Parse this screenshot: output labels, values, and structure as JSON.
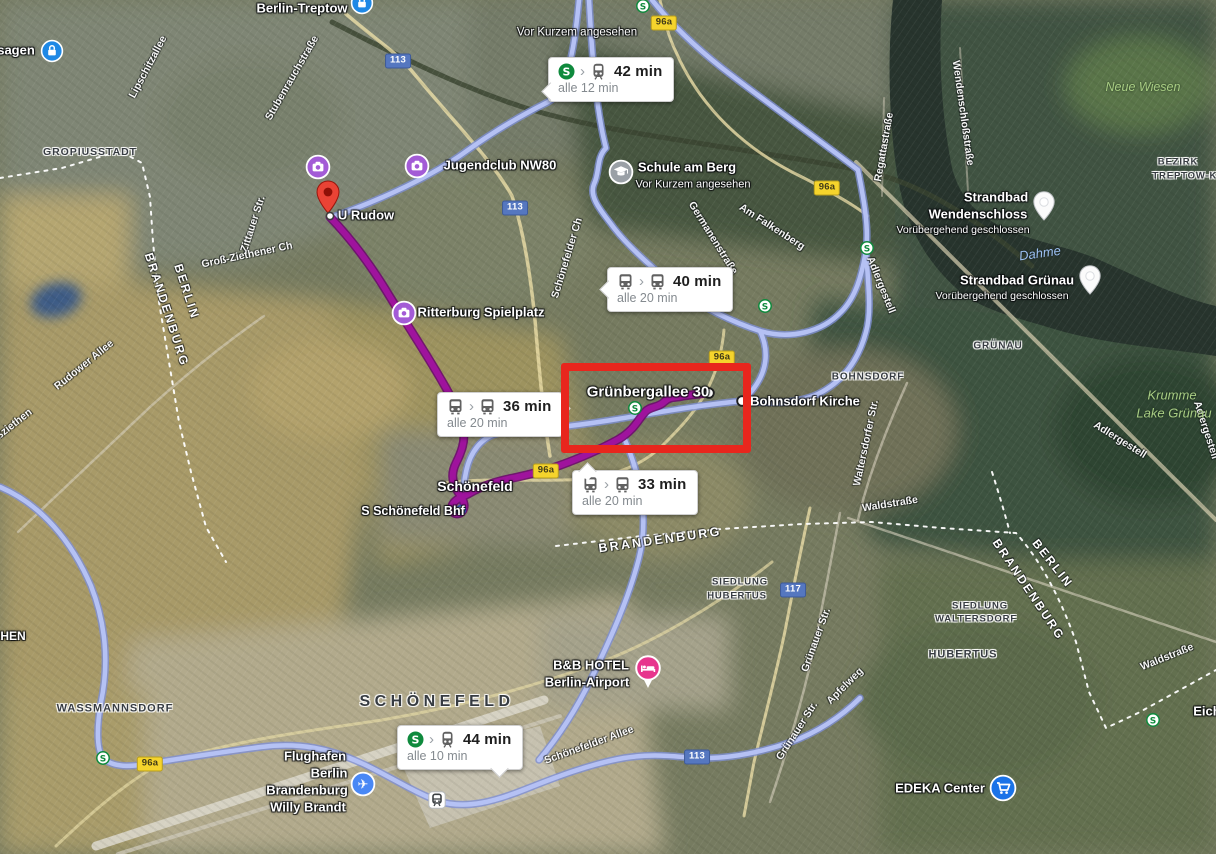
{
  "colors": {
    "route_blue": "#b7c3f6",
    "route_blue_edge": "#7e8fd4",
    "route_purple": "#a0139e",
    "route_purple_edge": "#6d0a6e",
    "highlight_red": "#e8261d",
    "shield_yellow_bg": "#f5d42c",
    "shield_yellow_text": "#403a18",
    "shield_yellow_border": "#b89e1d",
    "shield_blue_bg": "#5577c0",
    "shield_blue_text": "#ffffff",
    "sbahn_green": "#0f8a3d",
    "bubble_bg": "#ffffff"
  },
  "highlight_box": {
    "x": 561,
    "y": 363,
    "width": 174,
    "height": 74,
    "label": "Grünbergallee 30"
  },
  "transit_bubbles": [
    {
      "time": "42 min",
      "frequency": "alle 12 min",
      "mode_icons": [
        "sbahn-logo",
        "train"
      ],
      "x": 548,
      "y": 57,
      "tail": "bottom-left"
    },
    {
      "time": "40 min",
      "frequency": "alle 20 min",
      "mode_icons": [
        "bus",
        "bus"
      ],
      "x": 607,
      "y": 267,
      "tail": "left"
    },
    {
      "time": "36 min",
      "frequency": "alle 20 min",
      "mode_icons": [
        "bus",
        "bus"
      ],
      "x": 437,
      "y": 392,
      "tail": "right-top"
    },
    {
      "time": "33 min",
      "frequency": "alle 20 min",
      "mode_icons": [
        "bus",
        "bus"
      ],
      "x": 572,
      "y": 470,
      "tail": "left-top"
    },
    {
      "time": "44 min",
      "frequency": "alle 10 min",
      "mode_icons": [
        "sbahn-logo",
        "train"
      ],
      "x": 397,
      "y": 725,
      "tail": "bottom-right"
    }
  ],
  "route_shields": [
    {
      "label": "96a",
      "style": "yellow",
      "x": 664,
      "y": 23
    },
    {
      "label": "96a",
      "style": "yellow",
      "x": 827,
      "y": 188
    },
    {
      "label": "96a",
      "style": "yellow",
      "x": 722,
      "y": 358
    },
    {
      "label": "96a",
      "style": "yellow",
      "x": 546,
      "y": 471
    },
    {
      "label": "96a",
      "style": "yellow",
      "x": 150,
      "y": 764
    },
    {
      "label": "113",
      "style": "blue",
      "x": 398,
      "y": 61
    },
    {
      "label": "113",
      "style": "blue",
      "x": 515,
      "y": 208
    },
    {
      "label": "113",
      "style": "blue",
      "x": 697,
      "y": 757
    },
    {
      "label": "117",
      "style": "blue",
      "x": 793,
      "y": 590
    }
  ],
  "markers": [
    {
      "type": "lock",
      "x": 52,
      "y": 51
    },
    {
      "type": "lock",
      "x": 362,
      "y": 3
    },
    {
      "type": "sbahn",
      "x": 643,
      "y": 6
    },
    {
      "type": "camera",
      "x": 318,
      "y": 167
    },
    {
      "type": "camera",
      "x": 417,
      "y": 166
    },
    {
      "type": "pin-red",
      "x": 328,
      "y": 214,
      "anchor": "bottom"
    },
    {
      "type": "stop",
      "x": 330,
      "y": 216
    },
    {
      "type": "camera",
      "x": 404,
      "y": 313
    },
    {
      "type": "school",
      "x": 621,
      "y": 172
    },
    {
      "type": "pin-white",
      "x": 1044,
      "y": 221,
      "anchor": "bottom"
    },
    {
      "type": "pin-white",
      "x": 1090,
      "y": 295,
      "anchor": "bottom"
    },
    {
      "type": "sbahn",
      "x": 867,
      "y": 248
    },
    {
      "type": "stop-lg",
      "x": 742,
      "y": 401
    },
    {
      "type": "stop-lg",
      "x": 709,
      "y": 393
    },
    {
      "type": "sbahn",
      "x": 635,
      "y": 408
    },
    {
      "type": "stop-blue",
      "x": 461,
      "y": 510
    },
    {
      "type": "pin-hotel",
      "x": 648,
      "y": 690,
      "anchor": "bottom"
    },
    {
      "type": "airplane",
      "x": 363,
      "y": 784
    },
    {
      "type": "station",
      "x": 437,
      "y": 800
    },
    {
      "type": "sbahn",
      "x": 103,
      "y": 758
    },
    {
      "type": "sbahn",
      "x": 765,
      "y": 306
    },
    {
      "type": "sbahn",
      "x": 1153,
      "y": 720
    },
    {
      "type": "cart",
      "x": 1003,
      "y": 788
    }
  ],
  "labels": [
    {
      "text": "Berlin-Treptow",
      "x": 302,
      "y": 9,
      "cls": "poi",
      "size": 13
    },
    {
      "text": "sagen",
      "x": 16,
      "y": 51,
      "cls": "poi",
      "size": 13
    },
    {
      "text": "Vor Kurzem angesehen",
      "x": 577,
      "y": 33,
      "cls": "poi-sub",
      "size": 11.5
    },
    {
      "text": "Jugendclub NW80",
      "x": 500,
      "y": 166,
      "cls": "poi",
      "size": 13
    },
    {
      "text": "U Rudow",
      "x": 366,
      "y": 216,
      "cls": "poi",
      "size": 13
    },
    {
      "text": "Ritterburg Spielplatz",
      "x": 481,
      "y": 313,
      "cls": "poi",
      "size": 13
    },
    {
      "text": "Schule am Berg",
      "x": 687,
      "y": 168,
      "cls": "poi",
      "size": 13
    },
    {
      "text": "Vor Kurzem angesehen",
      "x": 693,
      "y": 185,
      "cls": "poi-sub",
      "size": 11
    },
    {
      "text": "Strandbad",
      "x": 996,
      "y": 198,
      "cls": "poi",
      "size": 13
    },
    {
      "text": "Wendenschloss",
      "x": 978,
      "y": 215,
      "cls": "poi",
      "size": 13
    },
    {
      "text": "Vorübergehend geschlossen",
      "x": 963,
      "y": 230,
      "cls": "poi-sub",
      "size": 10.5
    },
    {
      "text": "Strandbad Grünau",
      "x": 1017,
      "y": 281,
      "cls": "poi",
      "size": 13
    },
    {
      "text": "Vorübergehend geschlossen",
      "x": 1002,
      "y": 296,
      "cls": "poi-sub",
      "size": 10.5
    },
    {
      "text": "Bohnsdorf Kirche",
      "x": 805,
      "y": 402,
      "cls": "poi",
      "size": 13
    },
    {
      "text": "Grünbergallee 30",
      "x": 648,
      "y": 392,
      "cls": "dest",
      "size": 15
    },
    {
      "text": "Schönefeld",
      "x": 475,
      "y": 486,
      "cls": "poi",
      "size": 14
    },
    {
      "text": "S Schönefeld Bhf",
      "x": 413,
      "y": 511,
      "cls": "poi",
      "size": 12.5
    },
    {
      "text": "B&B HOTEL",
      "x": 591,
      "y": 666,
      "cls": "poi",
      "size": 13
    },
    {
      "text": "Berlin-Airport",
      "x": 587,
      "y": 683,
      "cls": "poi",
      "size": 13
    },
    {
      "text": "Flughafen",
      "x": 315,
      "y": 757,
      "cls": "poi",
      "size": 13
    },
    {
      "text": "Berlin",
      "x": 329,
      "y": 774,
      "cls": "poi",
      "size": 13
    },
    {
      "text": "Brandenburg",
      "x": 307,
      "y": 791,
      "cls": "poi",
      "size": 13
    },
    {
      "text": "Willy Brandt",
      "x": 308,
      "y": 808,
      "cls": "poi",
      "size": 13
    },
    {
      "text": "EDEKA Center",
      "x": 940,
      "y": 789,
      "cls": "poi",
      "size": 13
    },
    {
      "text": "Eichw",
      "x": 1212,
      "y": 712,
      "cls": "poi",
      "size": 13
    },
    {
      "text": "HEN",
      "x": 13,
      "y": 637,
      "cls": "poi",
      "size": 12
    },
    {
      "text": "GROPIUSSTADT",
      "x": 90,
      "y": 152,
      "cls": "district",
      "size": 10.5
    },
    {
      "text": "WASSMANNSDORF",
      "x": 115,
      "y": 709,
      "cls": "district",
      "size": 11
    },
    {
      "text": "SCHÖNEFELD",
      "x": 437,
      "y": 702,
      "cls": "district-big",
      "size": 16
    },
    {
      "text": "BOHNSDORF",
      "x": 868,
      "y": 377,
      "cls": "district",
      "size": 10
    },
    {
      "text": "GRÜNAU",
      "x": 998,
      "y": 346,
      "cls": "district",
      "size": 10
    },
    {
      "text": "SIEDLUNG",
      "x": 740,
      "y": 583,
      "cls": "district",
      "size": 9.5
    },
    {
      "text": "HUBERTUS",
      "x": 737,
      "y": 597,
      "cls": "district",
      "size": 9.5
    },
    {
      "text": "SIEDLUNG",
      "x": 980,
      "y": 607,
      "cls": "district",
      "size": 9.5
    },
    {
      "text": "WALTERSDORF",
      "x": 976,
      "y": 620,
      "cls": "district",
      "size": 9.5
    },
    {
      "text": "HUBERTUS",
      "x": 963,
      "y": 655,
      "cls": "district",
      "size": 11
    },
    {
      "text": "BEZIRK",
      "x": 1178,
      "y": 163,
      "cls": "district",
      "size": 9.5
    },
    {
      "text": "TREPTOW-KÖPEN",
      "x": 1200,
      "y": 177,
      "cls": "district",
      "size": 9.5
    },
    {
      "text": "BERLIN",
      "x": 186,
      "y": 292,
      "cls": "state",
      "size": 12,
      "rot": 72
    },
    {
      "text": "BRANDENBURG",
      "x": 166,
      "y": 310,
      "cls": "state",
      "size": 12,
      "rot": 72
    },
    {
      "text": "BRANDENBURG",
      "x": 660,
      "y": 540,
      "cls": "state",
      "size": 12.5,
      "rot": -8
    },
    {
      "text": "BERLIN",
      "x": 1052,
      "y": 564,
      "cls": "state",
      "size": 12,
      "rot": 52
    },
    {
      "text": "BRANDENBURG",
      "x": 1028,
      "y": 590,
      "cls": "state",
      "size": 12,
      "rot": 56
    },
    {
      "text": "Lipschitzallee",
      "x": 148,
      "y": 67,
      "cls": "street",
      "size": 10.5,
      "rot": -62
    },
    {
      "text": "Stubenrauchstraße",
      "x": 292,
      "y": 78,
      "cls": "street",
      "size": 10.5,
      "rot": -60
    },
    {
      "text": "Zittauer Str.",
      "x": 253,
      "y": 224,
      "cls": "street",
      "size": 10.5,
      "rot": -72
    },
    {
      "text": "Groß-Ziethener Ch",
      "x": 247,
      "y": 255,
      "cls": "street",
      "size": 10.5,
      "rot": -12
    },
    {
      "text": "Schönefelder Ch",
      "x": 567,
      "y": 258,
      "cls": "street",
      "size": 10.5,
      "rot": -73
    },
    {
      "text": "Germanenstraße",
      "x": 713,
      "y": 238,
      "cls": "street",
      "size": 10.5,
      "rot": 58
    },
    {
      "text": "Am Falkenberg",
      "x": 772,
      "y": 227,
      "cls": "street",
      "size": 10.5,
      "rot": 33
    },
    {
      "text": "Regattastraße",
      "x": 884,
      "y": 147,
      "cls": "street",
      "size": 10.5,
      "rot": -80
    },
    {
      "text": "Wendenschloßstraße",
      "x": 963,
      "y": 113,
      "cls": "street",
      "size": 10.5,
      "rot": 82
    },
    {
      "text": "Adlergestell",
      "x": 881,
      "y": 285,
      "cls": "street",
      "size": 10.5,
      "rot": 68
    },
    {
      "text": "Adlergestell",
      "x": 1120,
      "y": 440,
      "cls": "street",
      "size": 10.5,
      "rot": 32
    },
    {
      "text": "Adlergestell",
      "x": 1206,
      "y": 430,
      "cls": "street",
      "size": 10.5,
      "rot": 72
    },
    {
      "text": "Waltersdorfer Str.",
      "x": 866,
      "y": 443,
      "cls": "street",
      "size": 10.5,
      "rot": -78
    },
    {
      "text": "Waldstraße",
      "x": 890,
      "y": 504,
      "cls": "street",
      "size": 10.5,
      "rot": -9
    },
    {
      "text": "Waldstraße",
      "x": 1167,
      "y": 657,
      "cls": "street",
      "size": 10.5,
      "rot": -22
    },
    {
      "text": "Grünauer Str.",
      "x": 816,
      "y": 640,
      "cls": "street",
      "size": 10.5,
      "rot": -70
    },
    {
      "text": "Grünauer Str.",
      "x": 797,
      "y": 731,
      "cls": "street",
      "size": 10.5,
      "rot": -57
    },
    {
      "text": "Apfelweg",
      "x": 845,
      "y": 686,
      "cls": "street",
      "size": 10.5,
      "rot": -45
    },
    {
      "text": "Rudower Allee",
      "x": 84,
      "y": 365,
      "cls": "street",
      "size": 10.5,
      "rot": -39
    },
    {
      "text": "Schönefelder Allee",
      "x": 589,
      "y": 745,
      "cls": "street",
      "size": 10.5,
      "rot": -20
    },
    {
      "text": "ßziethen",
      "x": 14,
      "y": 424,
      "cls": "street",
      "size": 10.5,
      "rot": -38
    },
    {
      "text": "Dahme",
      "x": 1040,
      "y": 254,
      "cls": "water",
      "size": 13,
      "rot": -8
    },
    {
      "text": "Neue Wiesen",
      "x": 1143,
      "y": 87,
      "cls": "nature",
      "size": 12.5
    },
    {
      "text": "Krumme",
      "x": 1172,
      "y": 396,
      "cls": "nature",
      "size": 13
    },
    {
      "text": "Lake Grünau",
      "x": 1174,
      "y": 414,
      "cls": "nature",
      "size": 13
    }
  ]
}
